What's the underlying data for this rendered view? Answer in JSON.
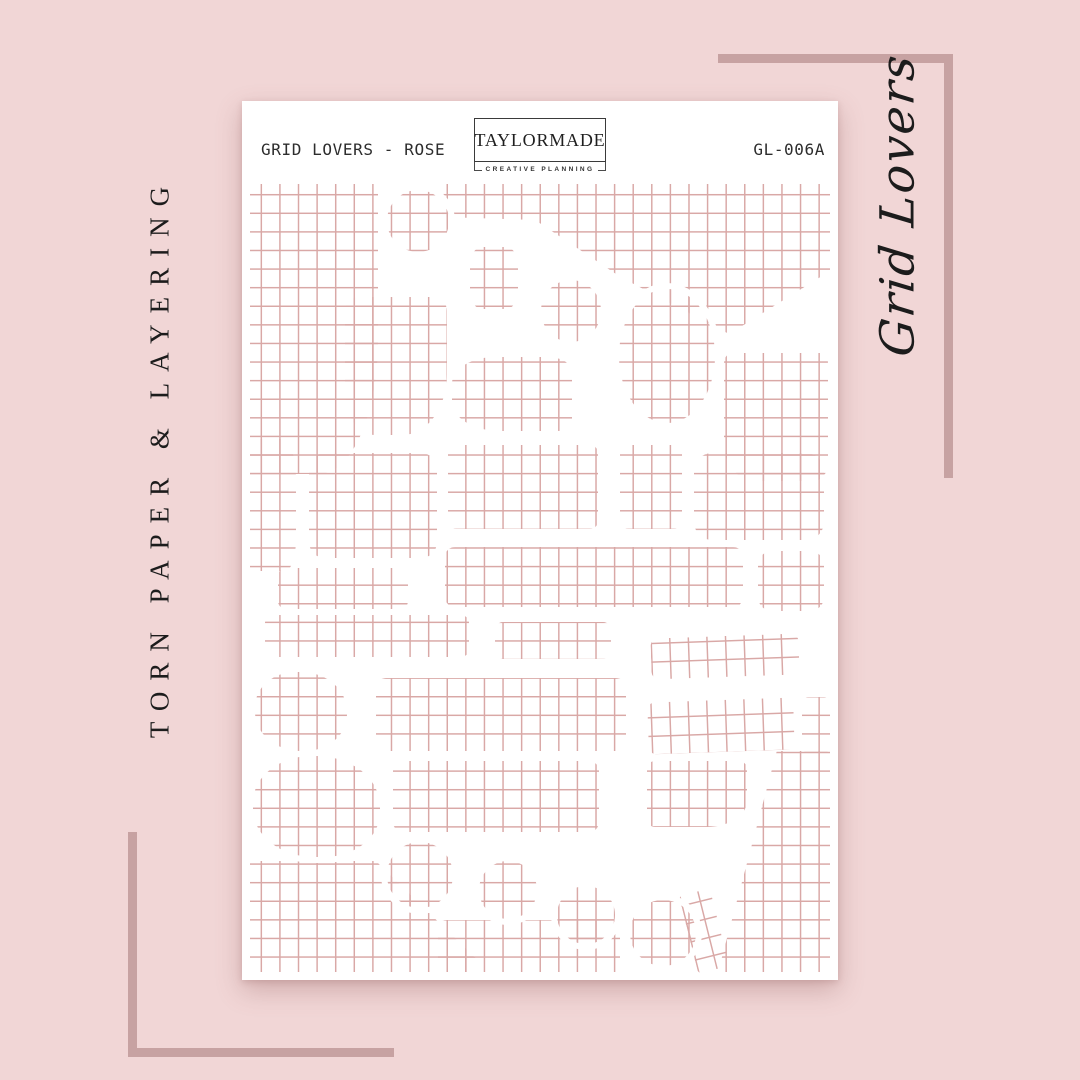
{
  "colors": {
    "background": "#f1d6d6",
    "bracket": "#c7a2a2",
    "grid_line": "#d9a8a6",
    "ink": "#1c1c1c",
    "sheet": "#ffffff",
    "sheet_ink": "#2d2d2d"
  },
  "side_labels": {
    "left": "TORN PAPER & LAYERING",
    "right": "Grid Lovers"
  },
  "sheet": {
    "title": "GRID LOVERS - ROSE",
    "code": "GL-006A",
    "logo": {
      "name": "TAYLORMADE",
      "tagline": "CREATIVE PLANNING"
    },
    "pieces": [
      {
        "x": 8,
        "y": 83,
        "w": 128,
        "h": 290,
        "br": "0 0 46% 0"
      },
      {
        "x": 200,
        "y": 83,
        "w": 388,
        "h": 150,
        "clip": "polygon(0 0,100% 0,100% 58%,74% 100%,46% 62%,24% 24%,0 22%)"
      },
      {
        "x": 482,
        "y": 252,
        "w": 104,
        "h": 128,
        "br": "8% 8% 14% 30%"
      },
      {
        "x": 103,
        "y": 196,
        "w": 102,
        "h": 138,
        "br": "14px 14px 44% 30%"
      },
      {
        "x": 210,
        "y": 256,
        "w": 120,
        "h": 74,
        "br": "36% 20% 12% 40%"
      },
      {
        "x": 8,
        "y": 338,
        "w": 46,
        "h": 132,
        "br": "0 30% 24% 0"
      },
      {
        "x": 67,
        "y": 352,
        "w": 128,
        "h": 105,
        "br": "16px"
      },
      {
        "x": 206,
        "y": 344,
        "w": 150,
        "h": 84,
        "br": "8px"
      },
      {
        "x": 378,
        "y": 344,
        "w": 62,
        "h": 84,
        "br": "8px"
      },
      {
        "x": 452,
        "y": 352,
        "w": 130,
        "h": 87,
        "br": "18px"
      },
      {
        "x": 203,
        "y": 446,
        "w": 298,
        "h": 60,
        "br": "10px"
      },
      {
        "x": 516,
        "y": 450,
        "w": 66,
        "h": 60,
        "br": "14px"
      },
      {
        "x": 36,
        "y": 467,
        "w": 130,
        "h": 41,
        "br": "8px"
      },
      {
        "x": 23,
        "y": 514,
        "w": 204,
        "h": 42,
        "br": "8px"
      },
      {
        "x": 253,
        "y": 521,
        "w": 116,
        "h": 37,
        "br": "8px"
      },
      {
        "x": 409,
        "y": 535,
        "w": 148,
        "h": 41,
        "br": "8px",
        "rot": -2
      },
      {
        "x": 134,
        "y": 577,
        "w": 250,
        "h": 73,
        "br": "10px"
      },
      {
        "x": 406,
        "y": 599,
        "w": 146,
        "h": 52,
        "br": "8px",
        "rot": -2
      },
      {
        "x": 560,
        "y": 596,
        "w": 28,
        "h": 56,
        "br": "6px"
      },
      {
        "x": 405,
        "y": 660,
        "w": 100,
        "h": 66,
        "br": "8px 8px 40% 8px"
      },
      {
        "x": 151,
        "y": 660,
        "w": 206,
        "h": 71,
        "br": "10px"
      },
      {
        "x": 448,
        "y": 650,
        "w": 140,
        "h": 221,
        "clip": "polygon(62% 0,100% 0,100% 100%,20% 100%)"
      },
      {
        "x": 8,
        "y": 760,
        "w": 233,
        "h": 111,
        "clip": "polygon(0 0,54% 0,100% 94%,100% 100%,0 100%)"
      },
      {
        "x": 196,
        "y": 819,
        "w": 182,
        "h": 52,
        "br": "8px 8px 0 0"
      },
      {
        "x": 446,
        "y": 790,
        "w": 32,
        "h": 80,
        "br": "4px",
        "rot": -14
      },
      {
        "x": 145,
        "y": 89,
        "w": 62,
        "h": 62,
        "br": "50%",
        "ring": 1
      },
      {
        "x": 228,
        "y": 146,
        "w": 48,
        "h": 62,
        "br": "26%",
        "ring": 1
      },
      {
        "x": 299,
        "y": 179,
        "w": 60,
        "h": 62,
        "br": "50%",
        "ring": 1
      },
      {
        "x": 377,
        "y": 188,
        "w": 96,
        "h": 134,
        "br": "50%",
        "ring": 1
      },
      {
        "x": 13,
        "y": 571,
        "w": 92,
        "h": 79,
        "br": "44% 50% 46% 50%",
        "ring": 1
      },
      {
        "x": 11,
        "y": 655,
        "w": 127,
        "h": 101,
        "br": "46% 50% 44% 48%",
        "ring": 1
      },
      {
        "x": 145,
        "y": 741,
        "w": 66,
        "h": 66,
        "br": "50%",
        "ring": 1
      },
      {
        "x": 237,
        "y": 760,
        "w": 58,
        "h": 58,
        "br": "50%",
        "ring": 1
      },
      {
        "x": 315,
        "y": 785,
        "w": 58,
        "h": 58,
        "br": "50%",
        "ring": 1
      },
      {
        "x": 388,
        "y": 799,
        "w": 66,
        "h": 66,
        "br": "50%",
        "ring": 1
      }
    ]
  }
}
